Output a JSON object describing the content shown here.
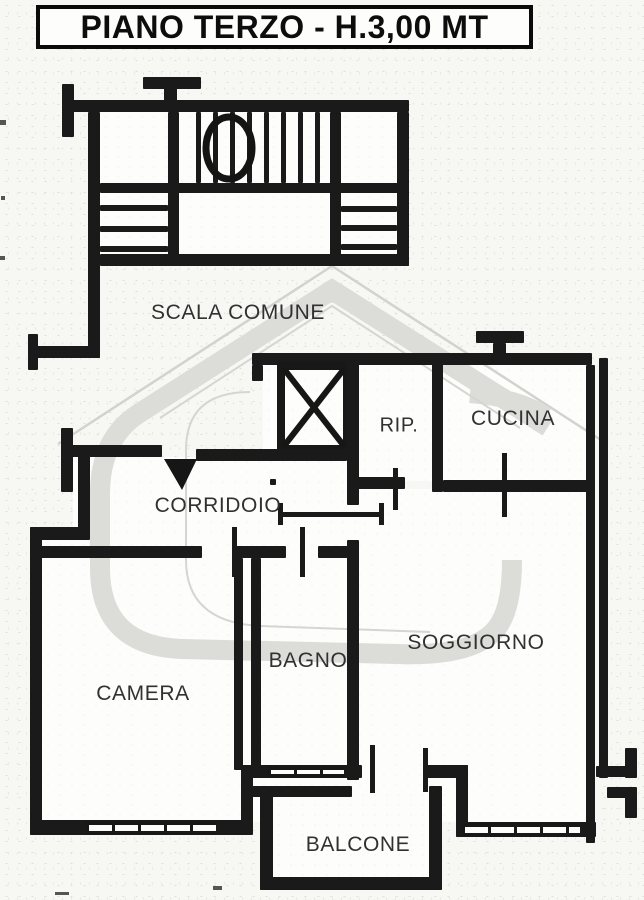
{
  "title": "PIANO TERZO - H.3,00 MT",
  "rooms": {
    "scala": "SCALA COMUNE",
    "corridoio": "CORRIDOIO",
    "rip": "RIP.",
    "cucina": "CUCINA",
    "camera": "CAMERA",
    "bagno": "BAGNO",
    "soggiorno": "SOGGIORNO",
    "balcone": "BALCONE"
  },
  "colors": {
    "wall": "#1a1a1a",
    "label": "#313131",
    "watermark": "#dcdcd9",
    "background": "#f7f7f4"
  }
}
